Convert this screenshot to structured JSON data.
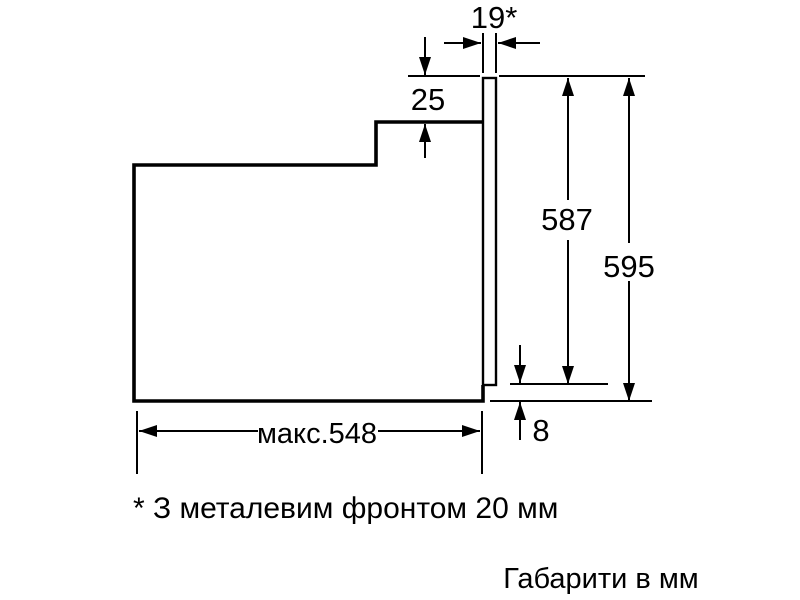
{
  "colors": {
    "ink": "#000000",
    "background": "#ffffff"
  },
  "diagram": {
    "dimensions": {
      "front_thickness": "19*",
      "top_step": "25",
      "front_height": "587",
      "total_height": "595",
      "bottom_lip": "8",
      "max_depth": "макс.548"
    },
    "footnote": "* З металевим фронтом 20 мм",
    "units_caption": "Габарити в мм"
  }
}
